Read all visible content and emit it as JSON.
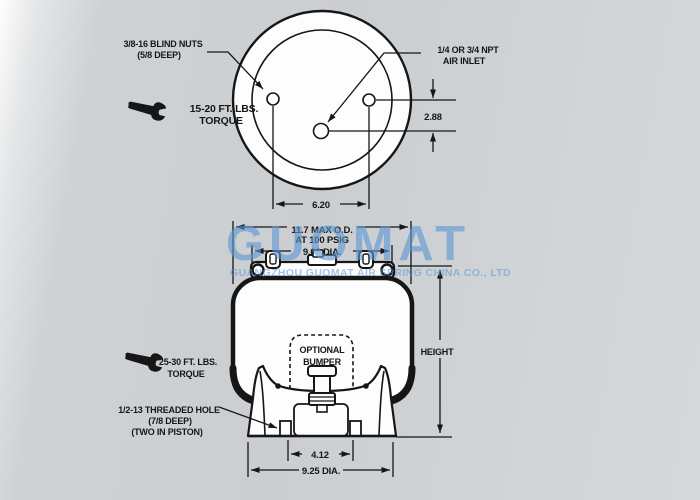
{
  "watermark": {
    "brand": "GUOMAT",
    "company": "GUANGZHOU GUOMAT AIR SPRING CHINA CO., LTD",
    "color": "#5f97d3"
  },
  "top_view": {
    "blind_nuts_label": {
      "line1": "3/8-16 BLIND NUTS",
      "line2": "(5/8 DEEP)"
    },
    "air_inlet_label": {
      "line1": "1/4 OR 3/4 NPT",
      "line2": "AIR INLET"
    },
    "torque_label": {
      "line1": "15-20 FT. LBS.",
      "line2": "TORQUE"
    },
    "dim_hole_offset": "2.88",
    "dim_bolt_spacing": "6.20"
  },
  "side_view": {
    "dim_max_od": {
      "line1": "11.7 MAX O.D.",
      "line2": "AT 100 PSIG"
    },
    "dim_top_plate": "9.00 DIA.",
    "bumper_label": {
      "line1": "OPTIONAL",
      "line2": "BUMPER"
    },
    "dim_height": "HEIGHT",
    "torque_label": {
      "line1": "25-30 FT. LBS.",
      "line2": "TORQUE"
    },
    "threaded_hole_label": {
      "line1": "1/2-13 THREADED HOLE",
      "line2": "(7/8 DEEP)",
      "line3": "(TWO IN PISTON)"
    },
    "dim_stud_spacing": "4.12",
    "dim_base": "9.25 DIA."
  }
}
